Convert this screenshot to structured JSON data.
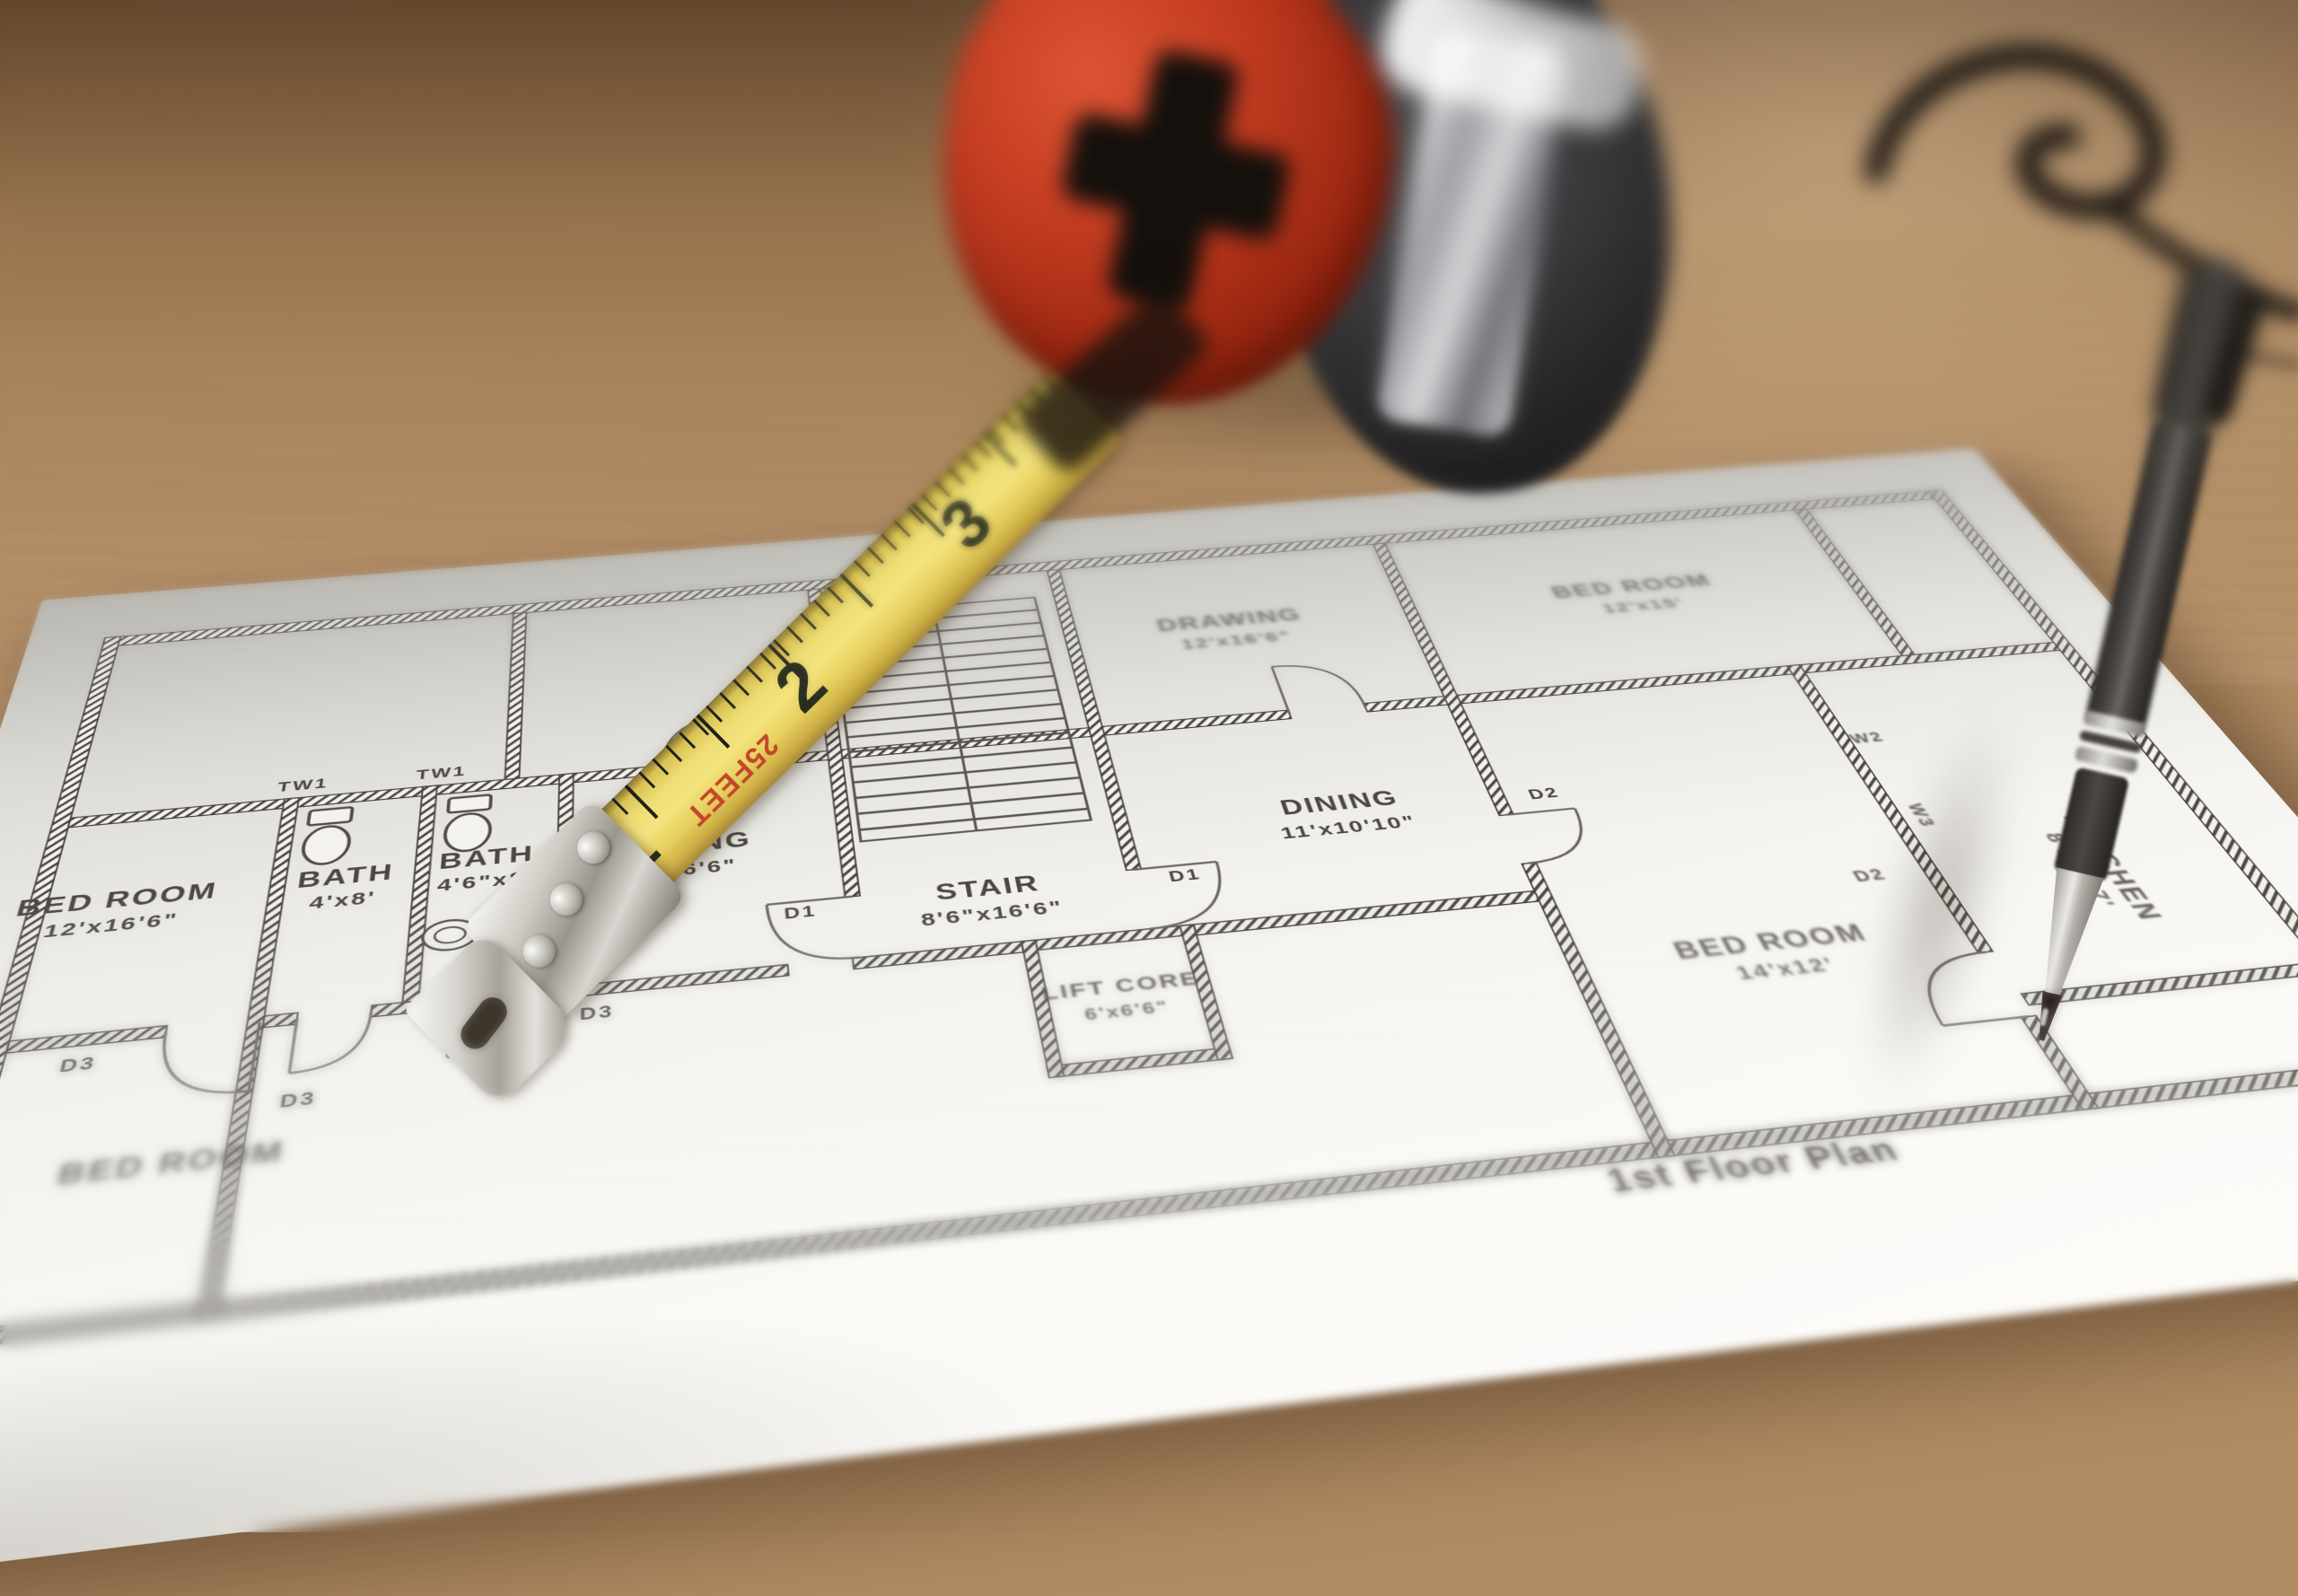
{
  "photo": {
    "description": "Yellow tape measure with red and black housing, and a dark mechanical pen, resting on an architectural floor plan printed on white paper on a wooden table"
  },
  "floor_plan": {
    "title": "1st Floor Plan",
    "rooms": [
      {
        "name": "DRAWING",
        "dim": "12'x16'6\""
      },
      {
        "name": "BED ROOM",
        "dim": "12'x15'"
      },
      {
        "name": "LIVING",
        "dim": "x16'6\""
      },
      {
        "name": "STAIR",
        "dim": "8'6\"x16'6\""
      },
      {
        "name": "DINING",
        "dim": "11'x10'10\""
      },
      {
        "name": "KITCHEN",
        "dim": "8'11\"x7'"
      },
      {
        "name": "LIFT CORE",
        "dim": "6'x6'6\""
      },
      {
        "name": "BATH",
        "dim": "4'x8'"
      },
      {
        "name": "BATH",
        "dim": "4'6\"x8'"
      },
      {
        "name": "BED ROOM",
        "dim": "12'x16'6\""
      },
      {
        "name": "BED ROOM",
        "dim": "14'x12'"
      },
      {
        "name": "BED ROOM",
        "dim": ""
      }
    ],
    "tags": {
      "door_d1": "D1",
      "door_d2": "D2",
      "door_d3": "D3",
      "window_w2": "W2",
      "window_w3": "W3",
      "wall_tw1": "TW1"
    }
  },
  "tape_measure": {
    "numbers": [
      "1",
      "2",
      "3"
    ],
    "print": "25FEET",
    "body_red": "#b5321e",
    "body_dark": "#2f2e30",
    "blade_yellow": "#ecd96b"
  },
  "pen": {
    "body_color": "#47433f"
  },
  "table": {
    "wood": "#b08b63"
  }
}
